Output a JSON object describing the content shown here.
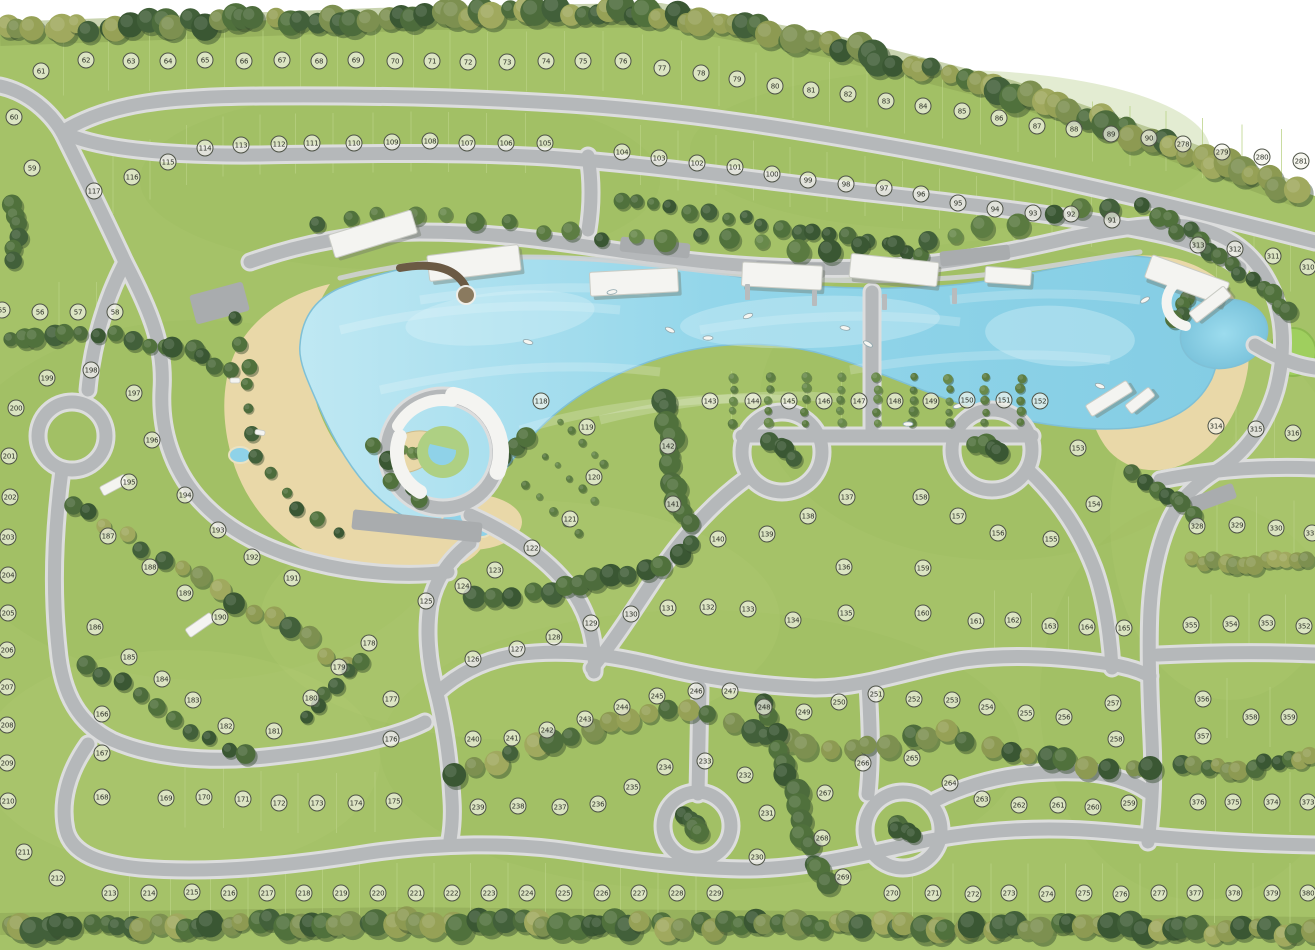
{
  "map_type": "residential-master-plan-with-lagoon",
  "palette": {
    "grass": "#a5c268",
    "grass_dark": "#8fae55",
    "road": "#b5b8ba",
    "road_edge": "#dcdddd",
    "water": "#93d6ea",
    "water_light": "#c6ecf6",
    "sand": "#e9d8a8",
    "tree_dark": "#47653a",
    "tree_olive": "#8d9a52",
    "building": "#f4f4f1",
    "badge_bg": "#f1f1e8",
    "badge_border": "#4e5347",
    "badge_text": "#2e3228"
  },
  "lots_format": [
    "lot_number",
    "x",
    "y"
  ],
  "lots": [
    [
      55,
      2,
      310
    ],
    [
      56,
      40,
      312
    ],
    [
      57,
      78,
      312
    ],
    [
      58,
      115,
      312
    ],
    [
      59,
      32,
      168
    ],
    [
      60,
      14,
      117
    ],
    [
      61,
      41,
      71
    ],
    [
      62,
      86,
      60
    ],
    [
      63,
      131,
      61
    ],
    [
      64,
      168,
      61
    ],
    [
      65,
      205,
      60
    ],
    [
      66,
      244,
      61
    ],
    [
      67,
      282,
      60
    ],
    [
      68,
      319,
      61
    ],
    [
      69,
      356,
      60
    ],
    [
      70,
      395,
      61
    ],
    [
      71,
      432,
      61
    ],
    [
      72,
      468,
      62
    ],
    [
      73,
      507,
      62
    ],
    [
      74,
      546,
      61
    ],
    [
      75,
      583,
      61
    ],
    [
      76,
      623,
      61
    ],
    [
      77,
      662,
      68
    ],
    [
      78,
      701,
      73
    ],
    [
      79,
      737,
      79
    ],
    [
      80,
      775,
      86
    ],
    [
      81,
      811,
      90
    ],
    [
      82,
      848,
      94
    ],
    [
      83,
      886,
      101
    ],
    [
      84,
      923,
      106
    ],
    [
      85,
      962,
      111
    ],
    [
      86,
      999,
      118
    ],
    [
      87,
      1037,
      126
    ],
    [
      88,
      1074,
      129
    ],
    [
      89,
      1111,
      134
    ],
    [
      90,
      1149,
      138
    ],
    [
      91,
      1112,
      220
    ],
    [
      92,
      1071,
      214
    ],
    [
      93,
      1033,
      213
    ],
    [
      94,
      995,
      209
    ],
    [
      95,
      958,
      203
    ],
    [
      96,
      921,
      194
    ],
    [
      97,
      884,
      188
    ],
    [
      98,
      846,
      184
    ],
    [
      99,
      808,
      180
    ],
    [
      100,
      772,
      174
    ],
    [
      101,
      735,
      167
    ],
    [
      102,
      697,
      163
    ],
    [
      103,
      659,
      158
    ],
    [
      104,
      622,
      152
    ],
    [
      105,
      545,
      143
    ],
    [
      106,
      506,
      143
    ],
    [
      107,
      467,
      143
    ],
    [
      108,
      430,
      141
    ],
    [
      109,
      392,
      142
    ],
    [
      110,
      354,
      143
    ],
    [
      111,
      312,
      143
    ],
    [
      112,
      279,
      144
    ],
    [
      113,
      241,
      145
    ],
    [
      114,
      205,
      148
    ],
    [
      115,
      168,
      162
    ],
    [
      116,
      132,
      177
    ],
    [
      117,
      94,
      191
    ],
    [
      118,
      541,
      401
    ],
    [
      119,
      587,
      427
    ],
    [
      120,
      594,
      477
    ],
    [
      121,
      570,
      519
    ],
    [
      122,
      532,
      548
    ],
    [
      123,
      495,
      570
    ],
    [
      124,
      463,
      586
    ],
    [
      125,
      426,
      601
    ],
    [
      126,
      473,
      659
    ],
    [
      127,
      517,
      649
    ],
    [
      128,
      554,
      637
    ],
    [
      129,
      591,
      623
    ],
    [
      130,
      631,
      614
    ],
    [
      131,
      668,
      608
    ],
    [
      132,
      708,
      607
    ],
    [
      133,
      748,
      609
    ],
    [
      134,
      793,
      620
    ],
    [
      135,
      846,
      613
    ],
    [
      136,
      844,
      567
    ],
    [
      137,
      847,
      497
    ],
    [
      138,
      808,
      516
    ],
    [
      139,
      767,
      534
    ],
    [
      140,
      718,
      539
    ],
    [
      141,
      673,
      504
    ],
    [
      142,
      668,
      446
    ],
    [
      143,
      710,
      401
    ],
    [
      144,
      753,
      401
    ],
    [
      145,
      789,
      401
    ],
    [
      146,
      824,
      401
    ],
    [
      147,
      859,
      401
    ],
    [
      148,
      895,
      401
    ],
    [
      149,
      931,
      401
    ],
    [
      150,
      967,
      400
    ],
    [
      151,
      1004,
      400
    ],
    [
      152,
      1040,
      401
    ],
    [
      153,
      1078,
      448
    ],
    [
      154,
      1094,
      504
    ],
    [
      155,
      1051,
      539
    ],
    [
      156,
      998,
      533
    ],
    [
      157,
      958,
      516
    ],
    [
      158,
      921,
      497
    ],
    [
      159,
      923,
      568
    ],
    [
      160,
      923,
      613
    ],
    [
      161,
      976,
      621
    ],
    [
      162,
      1013,
      620
    ],
    [
      163,
      1050,
      626
    ],
    [
      164,
      1087,
      627
    ],
    [
      165,
      1124,
      628
    ],
    [
      166,
      102,
      714
    ],
    [
      167,
      102,
      753
    ],
    [
      168,
      102,
      797
    ],
    [
      169,
      166,
      798
    ],
    [
      170,
      204,
      797
    ],
    [
      171,
      243,
      799
    ],
    [
      172,
      279,
      803
    ],
    [
      173,
      317,
      803
    ],
    [
      174,
      356,
      803
    ],
    [
      175,
      394,
      801
    ],
    [
      176,
      391,
      739
    ],
    [
      177,
      391,
      699
    ],
    [
      178,
      369,
      643
    ],
    [
      179,
      339,
      667
    ],
    [
      180,
      311,
      698
    ],
    [
      181,
      274,
      731
    ],
    [
      182,
      226,
      726
    ],
    [
      183,
      193,
      700
    ],
    [
      184,
      162,
      679
    ],
    [
      185,
      129,
      657
    ],
    [
      186,
      95,
      627
    ],
    [
      187,
      108,
      536
    ],
    [
      188,
      150,
      567
    ],
    [
      189,
      185,
      593
    ],
    [
      190,
      220,
      617
    ],
    [
      191,
      292,
      578
    ],
    [
      192,
      252,
      557
    ],
    [
      193,
      218,
      530
    ],
    [
      194,
      185,
      495
    ],
    [
      195,
      129,
      482
    ],
    [
      196,
      152,
      440
    ],
    [
      197,
      134,
      393
    ],
    [
      198,
      91,
      370
    ],
    [
      199,
      47,
      378
    ],
    [
      200,
      16,
      408
    ],
    [
      201,
      9,
      456
    ],
    [
      202,
      10,
      497
    ],
    [
      203,
      8,
      537
    ],
    [
      204,
      8,
      575
    ],
    [
      205,
      8,
      613
    ],
    [
      206,
      7,
      650
    ],
    [
      207,
      7,
      687
    ],
    [
      208,
      7,
      725
    ],
    [
      209,
      7,
      763
    ],
    [
      210,
      8,
      801
    ],
    [
      211,
      24,
      852
    ],
    [
      212,
      57,
      878
    ],
    [
      213,
      110,
      893
    ],
    [
      214,
      149,
      893
    ],
    [
      215,
      192,
      892
    ],
    [
      216,
      229,
      893
    ],
    [
      217,
      267,
      893
    ],
    [
      218,
      304,
      893
    ],
    [
      219,
      341,
      893
    ],
    [
      220,
      378,
      893
    ],
    [
      221,
      416,
      893
    ],
    [
      222,
      452,
      893
    ],
    [
      223,
      489,
      893
    ],
    [
      224,
      527,
      893
    ],
    [
      225,
      564,
      893
    ],
    [
      226,
      602,
      893
    ],
    [
      227,
      639,
      893
    ],
    [
      228,
      677,
      893
    ],
    [
      229,
      715,
      893
    ],
    [
      230,
      757,
      857
    ],
    [
      231,
      767,
      813
    ],
    [
      232,
      745,
      775
    ],
    [
      233,
      705,
      761
    ],
    [
      234,
      665,
      767
    ],
    [
      235,
      632,
      787
    ],
    [
      236,
      598,
      804
    ],
    [
      237,
      560,
      807
    ],
    [
      238,
      518,
      806
    ],
    [
      239,
      478,
      807
    ],
    [
      240,
      473,
      739
    ],
    [
      241,
      512,
      738
    ],
    [
      242,
      547,
      730
    ],
    [
      243,
      585,
      719
    ],
    [
      244,
      622,
      707
    ],
    [
      245,
      657,
      696
    ],
    [
      246,
      696,
      691
    ],
    [
      247,
      730,
      691
    ],
    [
      248,
      764,
      707
    ],
    [
      249,
      804,
      712
    ],
    [
      250,
      839,
      702
    ],
    [
      251,
      876,
      694
    ],
    [
      252,
      914,
      699
    ],
    [
      253,
      952,
      700
    ],
    [
      254,
      987,
      707
    ],
    [
      255,
      1026,
      713
    ],
    [
      256,
      1064,
      717
    ],
    [
      257,
      1113,
      703
    ],
    [
      258,
      1116,
      739
    ],
    [
      259,
      1129,
      803
    ],
    [
      260,
      1093,
      807
    ],
    [
      261,
      1058,
      805
    ],
    [
      262,
      1019,
      805
    ],
    [
      263,
      982,
      799
    ],
    [
      264,
      950,
      783
    ],
    [
      265,
      912,
      758
    ],
    [
      266,
      863,
      763
    ],
    [
      267,
      825,
      793
    ],
    [
      268,
      822,
      838
    ],
    [
      269,
      843,
      877
    ],
    [
      270,
      892,
      893
    ],
    [
      271,
      933,
      893
    ],
    [
      272,
      973,
      894
    ],
    [
      273,
      1009,
      893
    ],
    [
      274,
      1047,
      894
    ],
    [
      275,
      1084,
      893
    ],
    [
      276,
      1121,
      894
    ],
    [
      277,
      1159,
      893
    ],
    [
      278,
      1183,
      144
    ],
    [
      279,
      1222,
      152
    ],
    [
      280,
      1262,
      157
    ],
    [
      281,
      1301,
      161
    ],
    [
      310,
      1308,
      267
    ],
    [
      311,
      1273,
      256
    ],
    [
      312,
      1235,
      249
    ],
    [
      313,
      1198,
      245
    ],
    [
      314,
      1216,
      426
    ],
    [
      315,
      1256,
      429
    ],
    [
      316,
      1293,
      433
    ],
    [
      328,
      1197,
      526
    ],
    [
      329,
      1237,
      525
    ],
    [
      330,
      1276,
      528
    ],
    [
      331,
      1312,
      533
    ],
    [
      352,
      1304,
      626
    ],
    [
      353,
      1267,
      623
    ],
    [
      354,
      1231,
      624
    ],
    [
      355,
      1191,
      625
    ],
    [
      356,
      1203,
      699
    ],
    [
      357,
      1203,
      736
    ],
    [
      358,
      1251,
      717
    ],
    [
      359,
      1289,
      717
    ],
    [
      373,
      1308,
      802
    ],
    [
      374,
      1272,
      802
    ],
    [
      375,
      1233,
      802
    ],
    [
      376,
      1198,
      802
    ],
    [
      377,
      1195,
      893
    ],
    [
      378,
      1234,
      893
    ],
    [
      379,
      1272,
      893
    ],
    [
      380,
      1308,
      893
    ]
  ]
}
